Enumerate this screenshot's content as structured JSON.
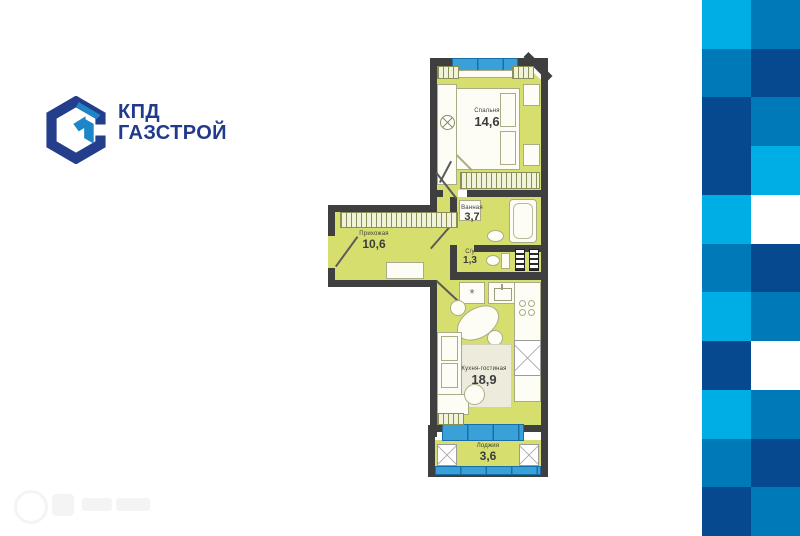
{
  "brand": {
    "logo_line1": "КПД",
    "logo_line2": "ГАЗСТРОЙ",
    "navy": "#243e8c",
    "light_blue": "#1d86c8",
    "text_color": "#223a8c"
  },
  "plan": {
    "wall_color": "#3f3f3f",
    "floor_color": "#d6df6e",
    "glass_color": "#3aa0d8",
    "rooms": [
      {
        "name": "Спальня",
        "area": "14,6"
      },
      {
        "name": "Ванная",
        "area": "3,7"
      },
      {
        "name": "С/у",
        "area": "1,3"
      },
      {
        "name": "Прихожая",
        "area": "10,6"
      },
      {
        "name": "Кухня-гостиная",
        "area": "18,9"
      },
      {
        "name": "Лоджия",
        "area": "3,6"
      }
    ],
    "stove_symbol": "*"
  },
  "checkerboard": {
    "colors": {
      "cyan": "#00aee6",
      "blue": "#0079b8",
      "navy": "#07498e",
      "white": "#ffffff"
    },
    "rows": [
      [
        "cyan",
        "blue"
      ],
      [
        "blue",
        "navy"
      ],
      [
        "navy",
        "blue"
      ],
      [
        "navy",
        "cyan"
      ],
      [
        "cyan",
        "white"
      ],
      [
        "blue",
        "navy"
      ],
      [
        "cyan",
        "blue"
      ],
      [
        "navy",
        "white"
      ],
      [
        "cyan",
        "blue"
      ],
      [
        "blue",
        "navy"
      ],
      [
        "navy",
        "blue"
      ]
    ]
  }
}
